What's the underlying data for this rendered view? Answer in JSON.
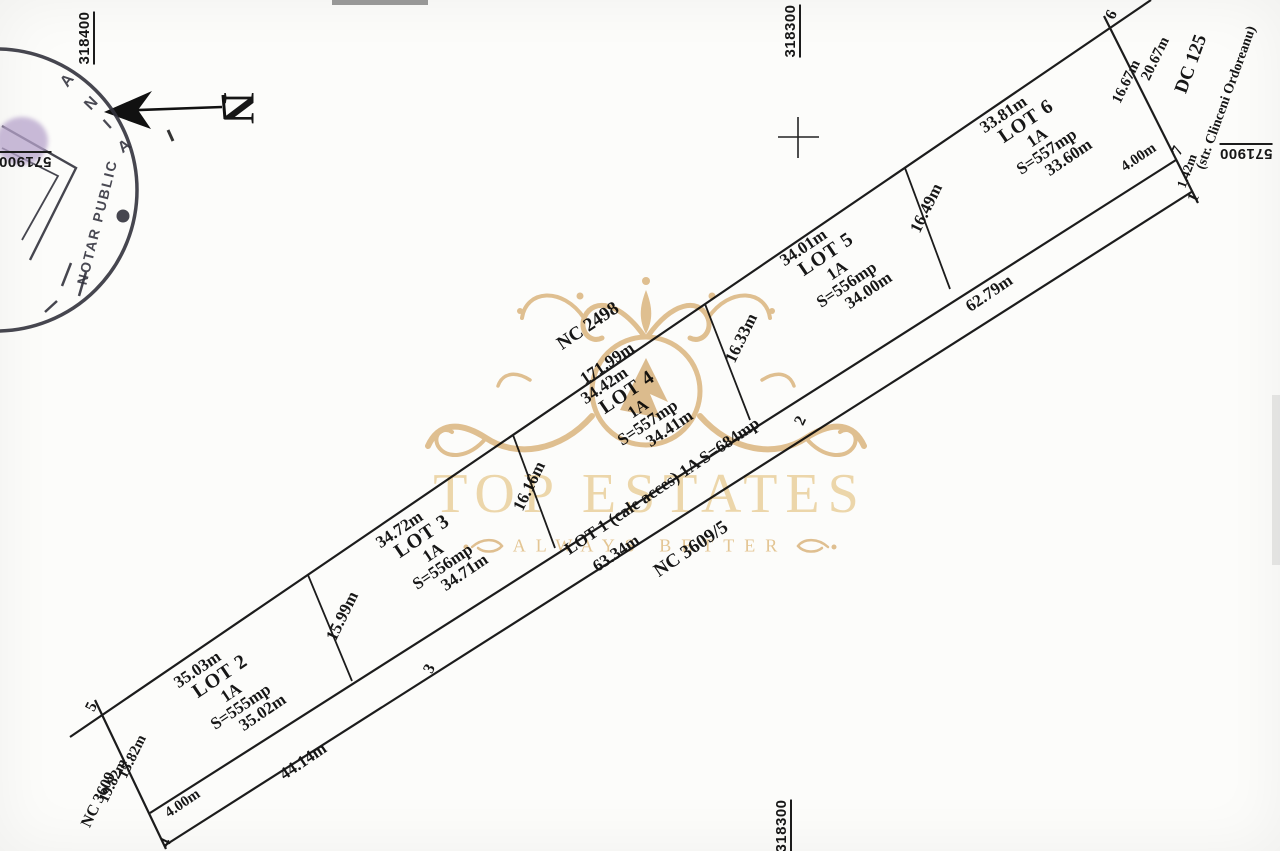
{
  "watermark": {
    "title": "TOP ESTATES",
    "tagline": "ALWAYS BETTER"
  },
  "north_label": "N",
  "stamp": {
    "arc_letters": [
      "A",
      "N",
      "I",
      "A"
    ],
    "line_text": "NOTAR PUBLIC"
  },
  "grid": {
    "top_left": "318400",
    "top_right": "318300",
    "bottom": "318300",
    "left": "571900",
    "right": "571900"
  },
  "neighbors": {
    "north": "NC 2498",
    "south": "NC 3609/5",
    "west": "NC 3609",
    "road": "DC 125",
    "road_street": "(str. Clinceni Ordoreanu)"
  },
  "outline": {
    "north_length": "171.99m",
    "west_lot": "15.82m",
    "west_total": "19.82m",
    "east_lot": "16.67m",
    "east_total": "20.67m"
  },
  "road_strip": {
    "label": "LOT 1 (cale acces) 1A  S=684mp",
    "seg_4_3": "44.14m",
    "seg_3_2": "63.34m",
    "seg_2_1": "62.79m",
    "end_left": "4.00m",
    "end_right": "4.00m",
    "end_edge": "1.42m"
  },
  "dividers": {
    "d23": "15.99m",
    "d34": "16.16m",
    "d45": "16.33m",
    "d56": "16.49m"
  },
  "lots": [
    {
      "name": "LOT 2",
      "category": "1A",
      "area": "S=555mp",
      "top": "35.03m",
      "bottom": "35.02m"
    },
    {
      "name": "LOT 3",
      "category": "1A",
      "area": "S=556mp",
      "top": "34.72m",
      "bottom": "34.71m"
    },
    {
      "name": "LOT 4",
      "category": "1A",
      "area": "S=557mp",
      "top": "34.42m",
      "bottom": "34.41m"
    },
    {
      "name": "LOT 5",
      "category": "1A",
      "area": "S=556mp",
      "top": "34.01m",
      "bottom": "34.00m"
    },
    {
      "name": "LOT 6",
      "category": "1A",
      "area": "S=557mp",
      "top": "33.81m",
      "bottom": "33.60m"
    }
  ],
  "vertices": {
    "v1": "1",
    "v2": "2",
    "v3": "3",
    "v4": "4",
    "v5": "5",
    "v6": "6",
    "v7": "7"
  },
  "colors": {
    "ink": "#1c1c1c",
    "gold": "#d9ae72",
    "stamp_ink": "#33333d"
  }
}
